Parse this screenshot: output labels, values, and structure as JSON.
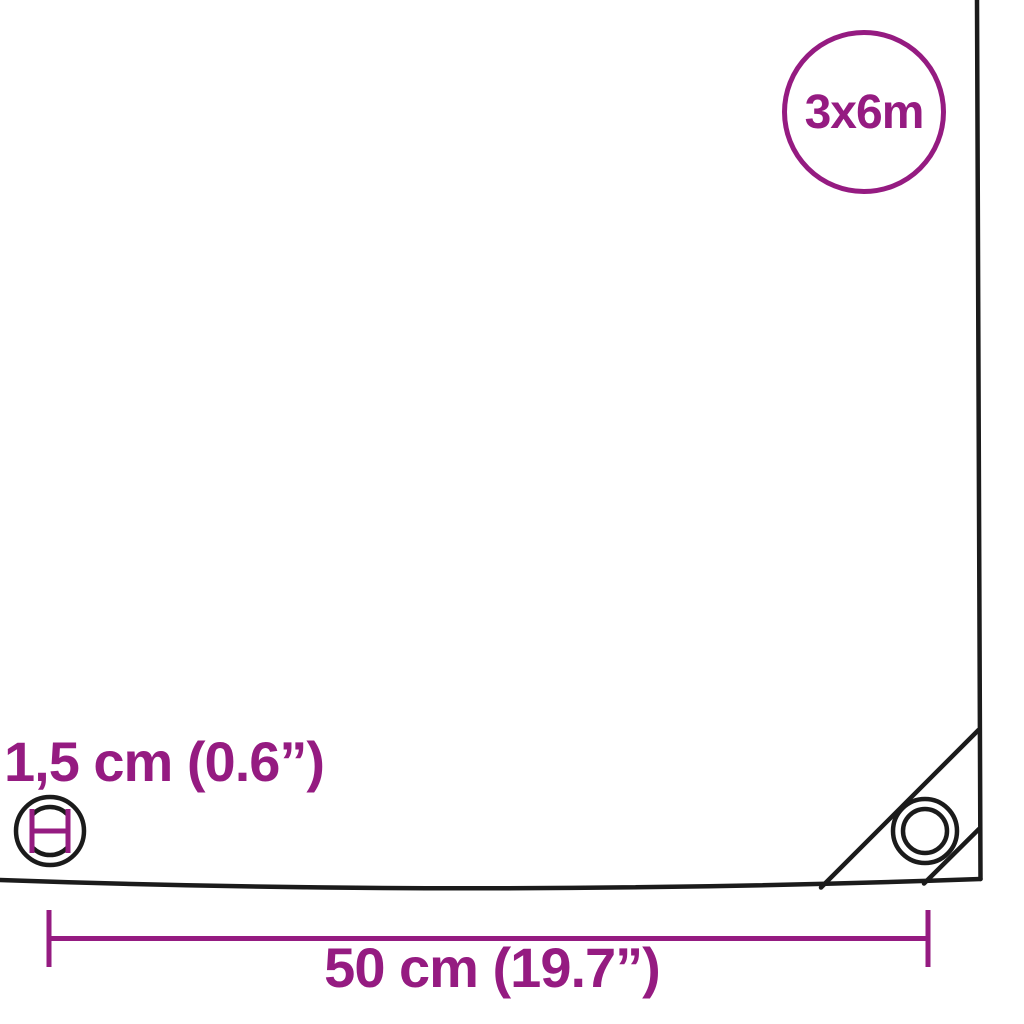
{
  "page": {
    "type": "product-dimension-diagram",
    "subject": "tarpaulin-corner-with-eyelets"
  },
  "product_diagram": {
    "size_badge_label": "3x6m",
    "eyelet_diameter_label": "1,5 cm (0.6”)",
    "eyelet_spacing_label": "50 cm (19.7”)"
  },
  "icons": {
    "eyelet_icon": "circle-with-inner-ring-and-diameter-marker",
    "corner_eyelet_icon": "concentric-circles-grommet",
    "size_badge_icon": "outlined-circle-badge"
  },
  "colors": {
    "accent": "#951B81",
    "outline": "#1B1B1B",
    "background": "#FFFFFF"
  }
}
